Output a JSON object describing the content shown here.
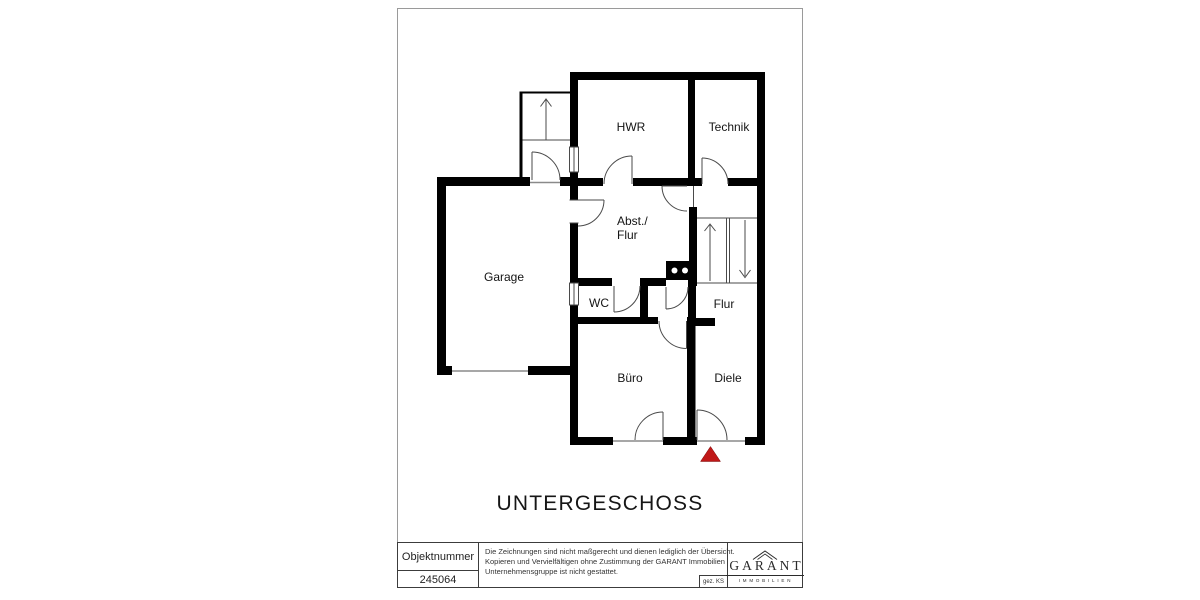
{
  "page": {
    "floor_title": "UNTERGESCHOSS"
  },
  "rooms": [
    {
      "label": "HWR"
    },
    {
      "label": "Technik"
    },
    {
      "label": "Abst./",
      "label2": "Flur"
    },
    {
      "label": "Garage"
    },
    {
      "label": "WC"
    },
    {
      "label": "Flur"
    },
    {
      "label": "Büro"
    },
    {
      "label": "Diele"
    }
  ],
  "footer": {
    "objektnummer_label": "Objektnummer",
    "objektnummer_value": "245064",
    "disclaimer_lines": [
      "Die Zeichnungen sind nicht maßgerecht und dienen lediglich der Übersicht.",
      "Kopieren und Vervielfältigen ohne Zustimmung der GARANT Immobilien",
      "Unternehmensgruppe ist nicht gestattet."
    ],
    "signature": "gez. KS",
    "logo_text": "GARANT",
    "logo_subtext": "IMMOBILIEN"
  },
  "plan": {
    "wall_color": "#000000",
    "line_color": "#4a4a4a",
    "entrance_marker_color": "#c01818",
    "entrance_marker": "red-triangle",
    "stair_markers": [
      "arrow-up",
      "arrow-down"
    ]
  }
}
